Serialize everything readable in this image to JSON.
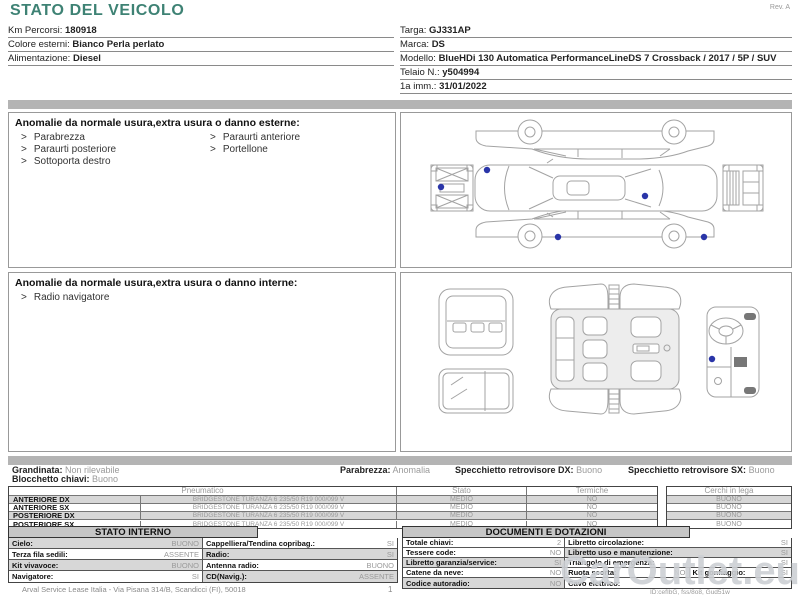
{
  "colors": {
    "accent_teal": "#3E8274",
    "bar_gray": "#B4B4B4",
    "row_shade": "#D7D7D7",
    "value_gray": "#9A9A9A",
    "damage_marker_blue": "#2A35A8",
    "head_gray": "#C6C6C6"
  },
  "doc": {
    "title": "STATO DEL VEICOLO",
    "rev": "Rev. A",
    "marker": ">",
    "watermark": "CarOutlet.eu",
    "id_note": "ID:cefIbG, fss/8o8, Gud51w",
    "footer": "Arval Service Lease Italia - Via Pisana 314/B, Scandicci (FI), 50018",
    "page_number": "1"
  },
  "header": {
    "left": [
      {
        "label": "Km Percorsi:",
        "value": "180918"
      },
      {
        "label": "Colore esterni:",
        "value": "Bianco Perla perlato"
      },
      {
        "label": "Alimentazione:",
        "value": "Diesel"
      }
    ],
    "right": [
      {
        "label": "Targa:",
        "value": "GJ331AP"
      },
      {
        "label": "Marca:",
        "value": "DS"
      },
      {
        "label": "Modello:",
        "value": "BlueHDi 130 Automatica PerformanceLineDS 7 Crossback / 2017 / 5P / SUV"
      },
      {
        "label": "Telaio N.:",
        "value": "y504994"
      },
      {
        "label": "1a imm.:",
        "value": "31/01/2022"
      }
    ]
  },
  "exterior_panel": {
    "title": "Anomalie da normale usura,extra usura o danno esterne:",
    "col1": [
      "Parabrezza",
      "Paraurti posteriore",
      "Sottoporta destro"
    ],
    "col2": [
      "Paraurti anteriore",
      "Portellone"
    ]
  },
  "interior_panel": {
    "title": "Anomalie da normale usura,extra usura o danno interne:",
    "col1": [
      "Radio navigatore"
    ]
  },
  "condition": {
    "line1": [
      {
        "label": "Grandinata:",
        "value": "Non rilevabile"
      },
      {
        "label": "Parabrezza:",
        "value": "Anomalia"
      },
      {
        "label": "Specchietto retrovisore DX:",
        "value": "Buono"
      },
      {
        "label": "Specchietto retrovisore SX:",
        "value": "Buono"
      }
    ],
    "line2": [
      {
        "label": "Blocchetto chiavi:",
        "value": "Buono"
      }
    ]
  },
  "tyres": {
    "col_pneumatico": "Pneumatico",
    "col_stato": "Stato",
    "col_termiche": "Termiche",
    "col_cerchi": "Cerchi in lega",
    "rows": [
      {
        "position": "ANTERIORE DX",
        "tyre": "BRIDGESTONE TURANZA 6 235/50 R19 000/099 V",
        "stato": "MEDIO",
        "termiche": "NO",
        "cerchi": "BUONO"
      },
      {
        "position": "ANTERIORE SX",
        "tyre": "BRIDGESTONE TURANZA 6 235/50 R19 000/099 V",
        "stato": "MEDIO",
        "termiche": "NO",
        "cerchi": "BUONO"
      },
      {
        "position": "POSTERIORE DX",
        "tyre": "BRIDGESTONE TURANZA 6 235/50 R19 000/099 V",
        "stato": "MEDIO",
        "termiche": "NO",
        "cerchi": "BUONO"
      },
      {
        "position": "POSTERIORE SX",
        "tyre": "BRIDGESTONE TURANZA 6 235/50 R19 000/099 V",
        "stato": "MEDIO",
        "termiche": "NO",
        "cerchi": "BUONO"
      }
    ]
  },
  "stato_interno": {
    "title": "STATO INTERNO",
    "rows": [
      [
        {
          "label": "Cielo:",
          "value": "BUONO"
        },
        {
          "label": "Cappelliera/Tendina copribag.:",
          "value": "SI"
        }
      ],
      [
        {
          "label": "Terza fila sedili:",
          "value": "ASSENTE"
        },
        {
          "label": "Radio:",
          "value": "SI"
        }
      ],
      [
        {
          "label": "Kit vivavoce:",
          "value": "BUONO"
        },
        {
          "label": "Antenna radio:",
          "value": "BUONO"
        }
      ],
      [
        {
          "label": "Navigatore:",
          "value": "SI"
        },
        {
          "label": "CD(Navig.):",
          "value": "ASSENTE"
        }
      ]
    ]
  },
  "documenti": {
    "title": "DOCUMENTI E DOTAZIONI",
    "rows": [
      [
        {
          "label": "Totale chiavi:",
          "value": "2"
        },
        {
          "label": "Libretto circolazione:",
          "value": "SI"
        }
      ],
      [
        {
          "label": "Tessere code:",
          "value": "NO"
        },
        {
          "label": "Libretto uso e manutenzione:",
          "value": "SI"
        }
      ],
      [
        {
          "label": "Libretto garanzia/service:",
          "value": "SI"
        },
        {
          "label": "Triangolo di emergenza:",
          "value": "SI"
        }
      ],
      [
        {
          "label": "Catene da neve:",
          "value": "NO"
        },
        {
          "label": "Ruota scorta:",
          "value": "NO"
        },
        {
          "label": "Kit gonfiaggio:",
          "value": "SI"
        }
      ],
      [
        {
          "label": "Codice autoradio:",
          "value": "NO"
        },
        {
          "label": "Cavo elettrico:",
          "value": ""
        }
      ]
    ]
  }
}
